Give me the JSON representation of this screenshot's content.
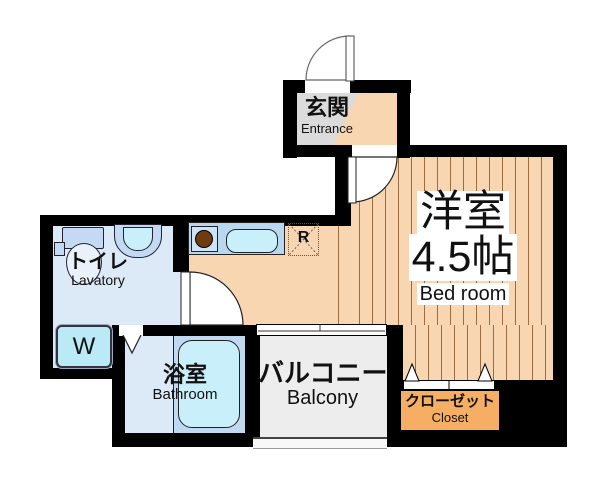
{
  "title": "Apartment floor plan",
  "rooms": {
    "entrance": {
      "ja": "玄関",
      "en": "Entrance"
    },
    "bedroom": {
      "ja": "洋室",
      "size": "4.5帖",
      "en": "Bed room"
    },
    "lavatory": {
      "ja": "トイレ",
      "en": "Lavatory"
    },
    "bathroom": {
      "ja": "浴室",
      "en": "Bathroom"
    },
    "balcony": {
      "ja": "バルコニー",
      "en": "Balcony"
    },
    "closet": {
      "ja": "クローゼット",
      "en": "Closet"
    }
  },
  "fixtures": {
    "washer_label": "W",
    "refrigerator_label": "R"
  },
  "colors": {
    "wall": "#000000",
    "wood_floor": "#F8D6B2",
    "wood_stripe": "#9A6C44",
    "wet_floor": "#DCE9F6",
    "fixture_blue": "#C3DAF2",
    "counter_blue": "#B9D8F0",
    "tub_cyan": "#C9F0FA",
    "washer_cyan": "#B9EAF6",
    "balcony_gray": "#EDEDED",
    "entrance_gray": "#DBDBDB",
    "closet_orange": "#F5AE63",
    "burner_brown": "#713B10"
  }
}
